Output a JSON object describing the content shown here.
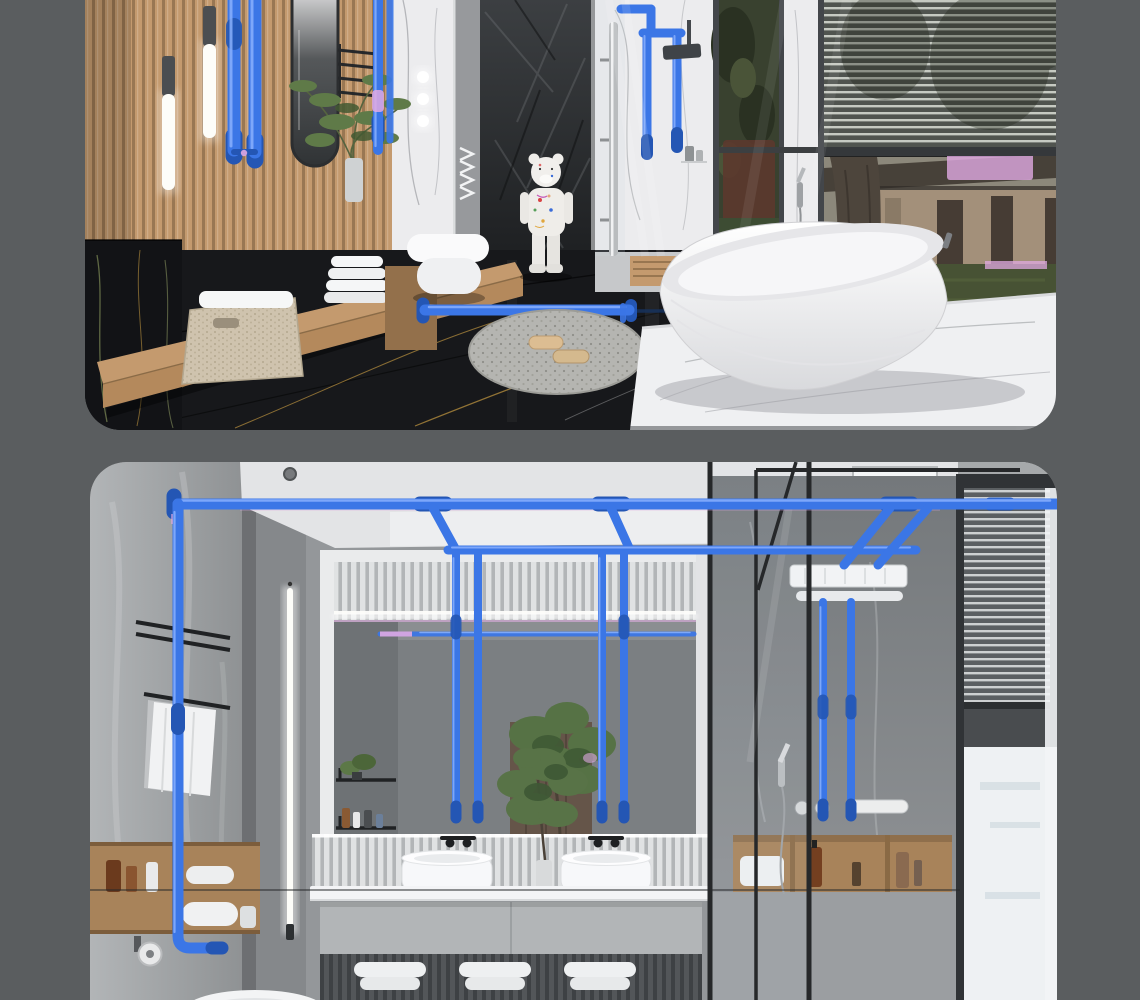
{
  "canvas": {
    "width": 1140,
    "height": 1000
  },
  "palette": {
    "bg": "#5a5d5f",
    "pipe": "#3b76e6",
    "pipeDeep": "#2456b4",
    "pipeLight": "#8fb4ff",
    "magenta": "#e0a9e2",
    "wood": "#c49a6e",
    "woodDark": "#7d5f41",
    "marbleWhite": "#ececee",
    "marbleVein": "#a7a9ad",
    "counterWhite": "#f0f0f3",
    "sinkWhite": "#fbfcfd",
    "blackMarble": "#17181b",
    "goldVein": "#bb923f",
    "grayWall": "#94979a",
    "cabinetGray": "#b2b5b7",
    "towelWhite": "#f0f1f2",
    "nicheWood": "#a8835a",
    "frameDark": "#26282a",
    "ledWhite": "#fdfdf9",
    "lawn": "#475234",
    "houseTan": "#a3907a",
    "roofDark": "#474139",
    "foliage": "#39412f"
  },
  "images": [
    {
      "name": "bathroom-render-top",
      "kind": "3d-interior-render",
      "subject": "modern bathroom with blue water-supply pipes highlighted",
      "elements": [
        "wood-slat-wall",
        "pendant-tube-lights",
        "oval-mirror",
        "green-plant",
        "towel-ladder",
        "marble-vanity",
        "rect-sink",
        "wall-faucet",
        "rolled-towels",
        "woven-basket",
        "wood-bench",
        "black-marble-wall",
        "wall-hung-toilet",
        "rock-feature-wall",
        "bear-figurine",
        "black-marble-floor",
        "floor-pipe",
        "pebble-rug",
        "slippers",
        "shower-glass",
        "chrome-shower-column",
        "blue-pipe-loop",
        "shower-head",
        "window-left-foliage-view",
        "marble-pier",
        "venetian-blinds",
        "house-view",
        "tree-trunk",
        "lawn",
        "magenta-glitches",
        "wood-sill",
        "marble-plinth",
        "freestanding-bathtub"
      ]
    },
    {
      "name": "bathroom-render-bottom",
      "kind": "3d-interior-render",
      "subject": "gray marble bathroom with ceiling-run blue pipes",
      "elements": [
        "gray-marble-walls",
        "ceiling",
        "ceiling-spotlight",
        "ceiling-vent",
        "main-ceiling-pipe",
        "left-drop-pipe",
        "secondary-pipe",
        "mirror-drop-pipes",
        "shower-drop-pipes",
        "towel-rack",
        "hanging-towels",
        "led-strip-light",
        "mirror-niche",
        "backlit-slat-band",
        "wall-shelves",
        "mirror-reflection-plant",
        "wood-door-reflection",
        "in-mirror-pipe",
        "wall-faucets",
        "double-vessel-sinks",
        "marble-counter",
        "vanity-cabinet",
        "rolled-towels",
        "counter-plant",
        "glass-partition",
        "rain-shower-panel",
        "hand-shower",
        "shower-niche-shelves",
        "toiletry-bottles",
        "storage-niche",
        "toilet-paper-holder",
        "toilet-rim",
        "venetian-blinds-window",
        "bright-window"
      ]
    }
  ]
}
